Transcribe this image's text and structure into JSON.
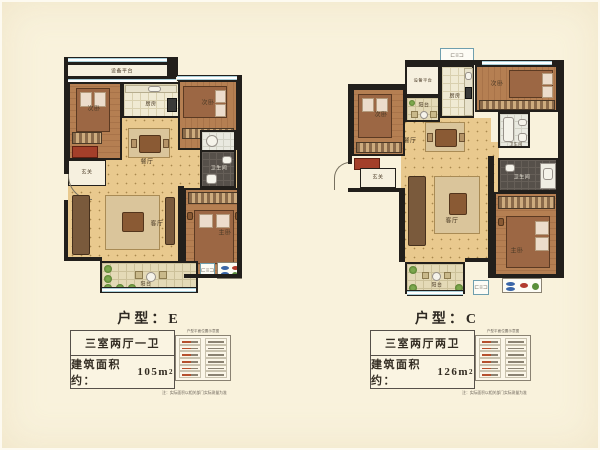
{
  "page": {
    "background": "#f9f2dc"
  },
  "marker_glyph": "⊏≡⊐",
  "plans": [
    {
      "title": "户型：E",
      "spec": "三室两厅一卫",
      "area_label": "建筑面积约：",
      "area_value": "105",
      "area_unit_base": "m",
      "area_unit_sup": "2",
      "legend_title": "户型平面位置示意图",
      "note": "注：实际面积以相关部门实际测量为准",
      "rooms": {
        "equipment": "设备平台",
        "kitchen": "厨房",
        "bed_left": "次卧",
        "bed_top": "次卧",
        "entry": "玄关",
        "dining": "餐厅",
        "bath": "卫生间",
        "living": "客厅",
        "master": "主卧",
        "balcony": "阳台"
      }
    },
    {
      "title": "户型：C",
      "spec": "三室两厅两卫",
      "area_label": "建筑面积约：",
      "area_value": "126",
      "area_unit_base": "m",
      "area_unit_sup": "2",
      "legend_title": "户型平面位置示意图",
      "note": "注：实际面积以相关部门实际测量为准",
      "rooms": {
        "equipment": "设备平台",
        "kitchen": "厨房",
        "bed_top": "次卧",
        "balcony_top": "阳台",
        "bed_left": "次卧",
        "entry": "玄关",
        "dining": "餐厅",
        "bath1": "卫生间",
        "bath2": "卫生间",
        "living": "客厅",
        "master": "主卧",
        "balcony": "阳台"
      }
    }
  ]
}
